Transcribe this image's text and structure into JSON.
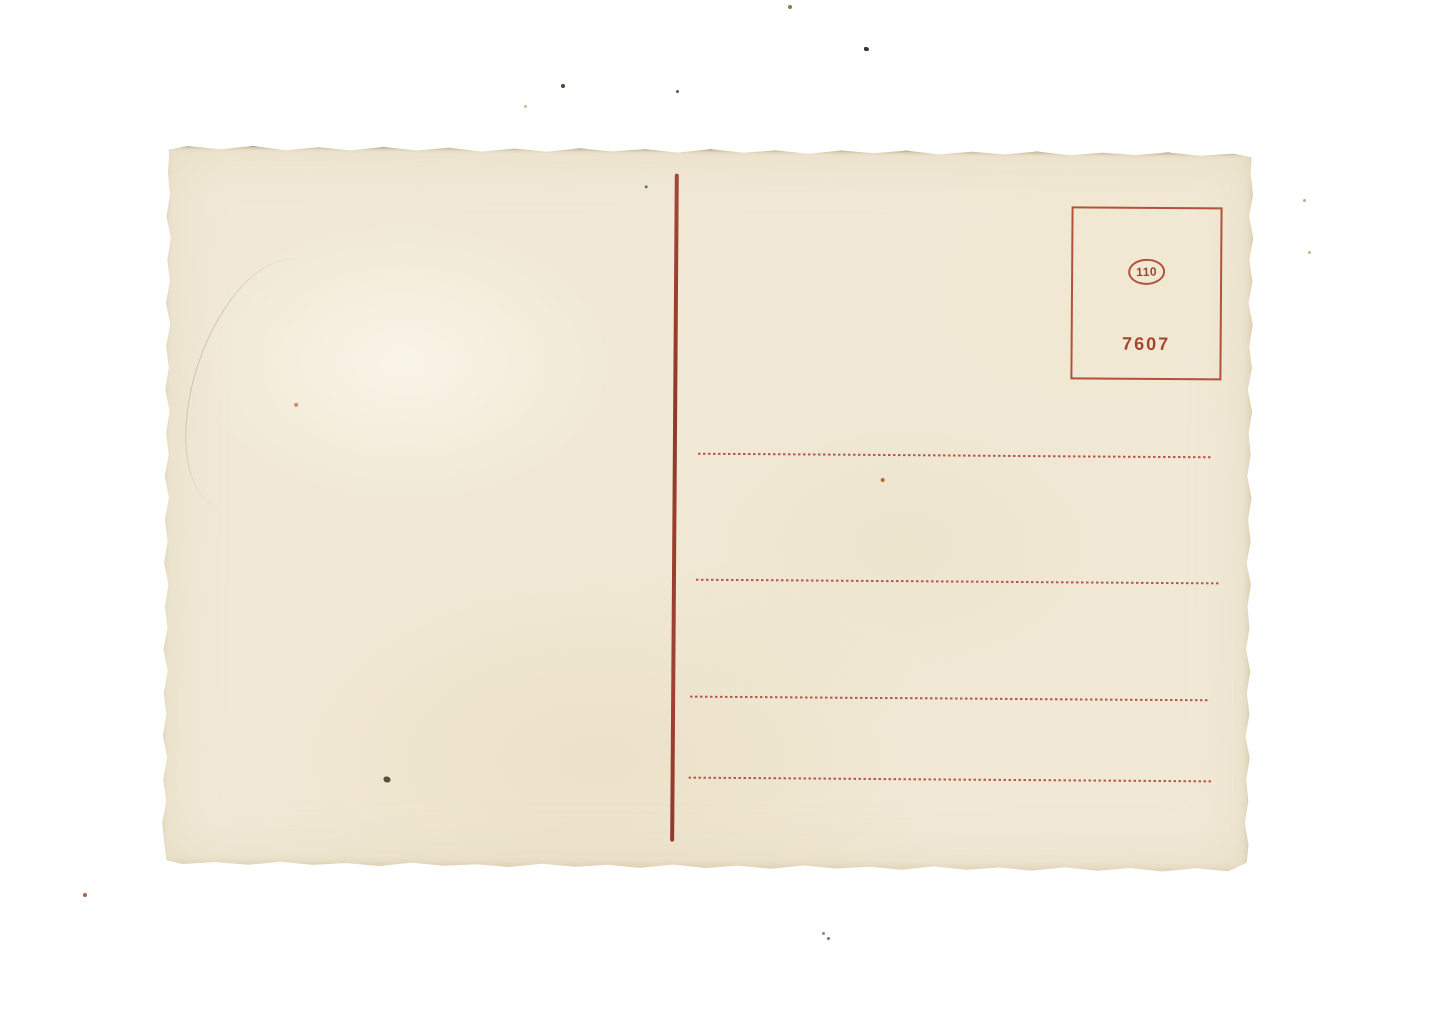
{
  "page": {
    "background_color": "#ffffff"
  },
  "postcard": {
    "colors": {
      "card_background": "#f1e9d6",
      "divider_red": "#9d4030",
      "dotted_line_red": "#b34a3c",
      "stamp_print_red": "#ae4a35"
    },
    "stamp_box": {
      "series_number": "110",
      "catalog_number": "7607"
    },
    "address_line_count": 4
  }
}
